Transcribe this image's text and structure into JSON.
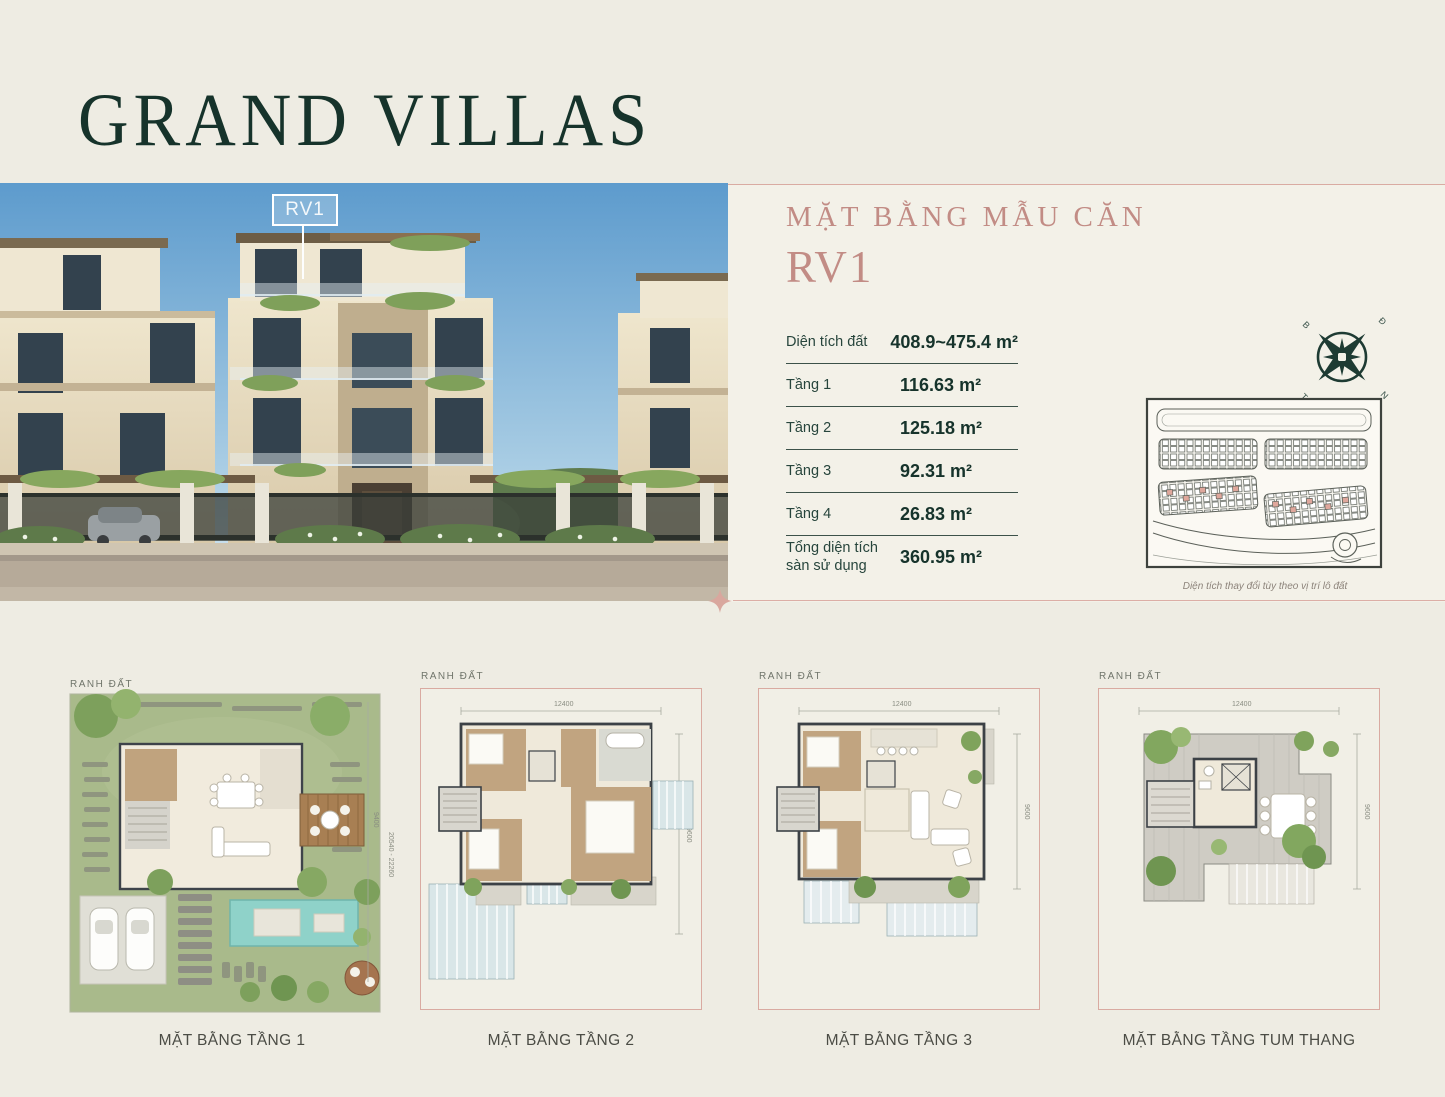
{
  "page": {
    "title": "GRAND VILLAS"
  },
  "photo": {
    "callout_label": "RV1"
  },
  "panel": {
    "heading_line1": "MẶT BẰNG MẪU CĂN",
    "heading_line2": "RV1",
    "specs": [
      {
        "label": "Diện tích đất",
        "value": "408.9~475.4 m²"
      },
      {
        "label": "Tầng 1",
        "value": "116.63 m²"
      },
      {
        "label": "Tầng 2",
        "value": "125.18 m²"
      },
      {
        "label": "Tầng 3",
        "value": "92.31 m²"
      },
      {
        "label": "Tầng 4",
        "value": "26.83 m²"
      },
      {
        "label": "Tổng diện tích sàn sử dụng",
        "value": "360.95 m²"
      }
    ],
    "compass": {
      "nw": "B",
      "ne": "Đ",
      "se": "N",
      "sw": "T"
    },
    "map_caption": "Diện tích thay đổi tùy theo vị trí lô đất"
  },
  "floorplans": [
    {
      "boundary_label": "RANH ĐẤT",
      "dim_right_a": "9400",
      "dim_right_b": "20540 - 22260",
      "caption": "MẶT BẰNG TẦNG 1"
    },
    {
      "boundary_label": "RANH ĐẤT",
      "dim_top": "12400",
      "dim_right": "9600",
      "caption": "MẶT BẰNG TẦNG 2"
    },
    {
      "boundary_label": "RANH ĐẤT",
      "dim_top": "12400",
      "dim_right": "9600",
      "caption": "MẶT BẰNG TẦNG 3"
    },
    {
      "boundary_label": "RANH ĐẤT",
      "dim_top": "12400",
      "dim_right": "9600",
      "caption": "MẶT BẰNG TẦNG TUM THANG"
    }
  ],
  "colors": {
    "background": "#eeece3",
    "panel_background": "#f3f1e8",
    "brand_green": "#16332b",
    "brand_rose": "#c28c85",
    "divider_pink": "#dcaea6"
  }
}
